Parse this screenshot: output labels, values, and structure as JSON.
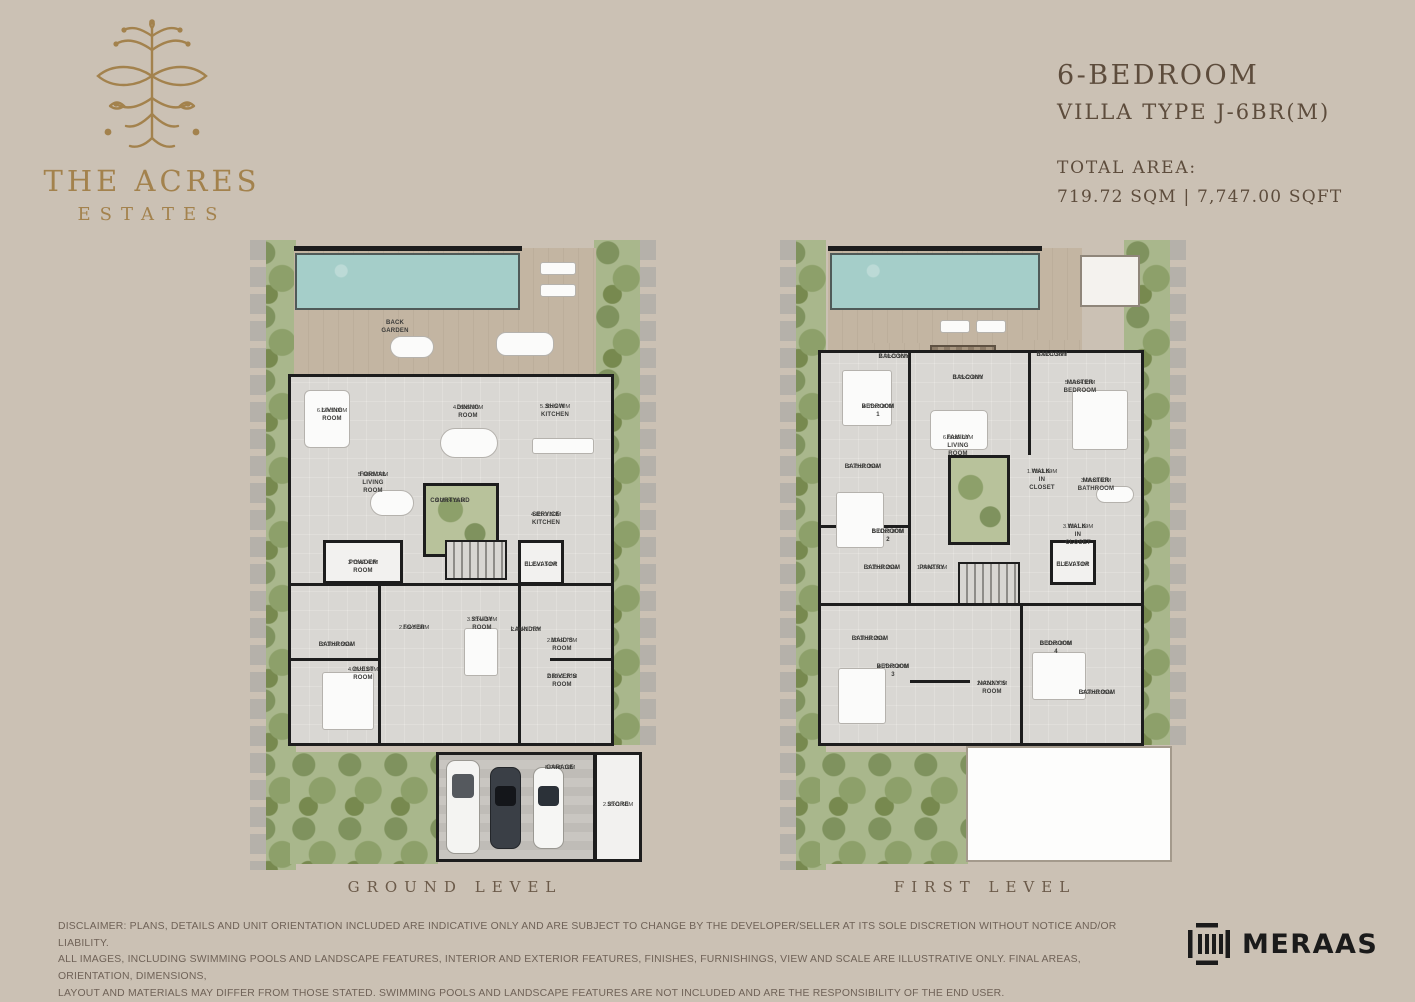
{
  "brand": {
    "name_line1": "THE ACRES",
    "name_line2": "ESTATES"
  },
  "header": {
    "title_line1": "6-BEDROOM",
    "title_line2": "VILLA TYPE J-6BR(M)",
    "total_area_label": "TOTAL AREA:",
    "total_area_value": "719.72 SQM | 7,747.00 SQFT"
  },
  "plans": {
    "ground": {
      "caption": "GROUND LEVEL",
      "outdoor_label": "BACK GARDEN",
      "rooms": [
        {
          "name": "LIVING ROOM",
          "dims": "6.60x5.00M"
        },
        {
          "name": "DINING ROOM",
          "dims": "4.35x5.00M"
        },
        {
          "name": "SHOW KITCHEN",
          "dims": "5.35x5.70M"
        },
        {
          "name": "FORMAL LIVING ROOM",
          "dims": "5.60x5.00M"
        },
        {
          "name": "COURTYARD",
          "dims": "3.95x4.05M"
        },
        {
          "name": "SERVICE KITCHEN",
          "dims": "4.85x3.50M"
        },
        {
          "name": "POWDER ROOM",
          "dims": "3.75x2.40M"
        },
        {
          "name": "ELEVATOR",
          "dims": "1.75x1.50M"
        },
        {
          "name": "FOYER",
          "dims": "2.55x3.50M"
        },
        {
          "name": "STUDY ROOM",
          "dims": "3.75x4.50M"
        },
        {
          "name": "LAUNDRY",
          "dims": "2.00x1.75M"
        },
        {
          "name": "MAID'S ROOM",
          "dims": "2.30x2.70M"
        },
        {
          "name": "BATHROOM",
          "dims": "3.10x2.55M"
        },
        {
          "name": "GUEST ROOM",
          "dims": "4.75x3.80M"
        },
        {
          "name": "DRIVER'S ROOM",
          "dims": "2.10x2.20M"
        },
        {
          "name": "GARAGE",
          "dims": "8.00x6.10M"
        },
        {
          "name": "STORE",
          "dims": "2.25x1.60M"
        }
      ]
    },
    "first": {
      "caption": "FIRST LEVEL",
      "rooms": [
        {
          "name": "BALCONY",
          "dims": "2.70x3.95M"
        },
        {
          "name": "BALCONY",
          "dims": "3.75x2.00M"
        },
        {
          "name": "BALCONY",
          "dims": "3.10x1.50M"
        },
        {
          "name": "BEDROOM 1",
          "dims": "4.75x3.80M"
        },
        {
          "name": "MASTER BEDROOM",
          "dims": "5.10x4.95M"
        },
        {
          "name": "FAMILY LIVING ROOM",
          "dims": "6.00x5.00M"
        },
        {
          "name": "BATHROOM",
          "dims": "2.75x2.05M"
        },
        {
          "name": "WALK-IN CLOSET",
          "dims": "1.70x3.80M"
        },
        {
          "name": "MASTER BATHROOM",
          "dims": "3.05x3.60M"
        },
        {
          "name": "BEDROOM 2",
          "dims": "5.00x3.80M"
        },
        {
          "name": "WALK-IN CLOSET",
          "dims": "3.10x1.80M"
        },
        {
          "name": "BATHROOM",
          "dims": "3.15x2.25M"
        },
        {
          "name": "PANTRY",
          "dims": "1.60x2.50M"
        },
        {
          "name": "ELEVATOR",
          "dims": "1.75x1.50M"
        },
        {
          "name": "BATHROOM",
          "dims": "3.10x2.25M"
        },
        {
          "name": "BEDROOM 3",
          "dims": "4.75x3.80M"
        },
        {
          "name": "NANNY'S ROOM",
          "dims": "2.60x2.30M"
        },
        {
          "name": "BEDROOM 4",
          "dims": "3.30x5.00M"
        },
        {
          "name": "BATHROOM",
          "dims": "2.20x3.65M"
        }
      ]
    }
  },
  "footer": {
    "disclaimer_line1": "DISCLAIMER: PLANS, DETAILS AND UNIT ORIENTATION INCLUDED ARE INDICATIVE ONLY AND ARE SUBJECT TO CHANGE BY THE DEVELOPER/SELLER AT ITS SOLE DISCRETION WITHOUT NOTICE AND/OR LIABILITY.",
    "disclaimer_line2": "ALL IMAGES, INCLUDING SWIMMING POOLS AND LANDSCAPE FEATURES, INTERIOR AND EXTERIOR FEATURES, FINISHES, FURNISHINGS, VIEW AND SCALE ARE ILLUSTRATIVE ONLY. FINAL AREAS, ORIENTATION, DIMENSIONS,",
    "disclaimer_line3": "LAYOUT AND MATERIALS MAY DIFFER FROM THOSE STATED. SWIMMING POOLS AND LANDSCAPE FEATURES ARE NOT INCLUDED AND ARE THE RESPONSIBILITY OF THE END USER.",
    "developer_logo_text": "MERAAS"
  },
  "colors": {
    "page_background": "#cbc1b4",
    "brand_gold": "#a3824d",
    "heading_brown": "#5d4c3c",
    "pool_teal": "#a5cec9",
    "deck_tan": "#c3b5a2",
    "landscape_green": "#a9b78c",
    "wall_black": "#1d1d1d",
    "floor_gray": "#e7e5e1",
    "logo_black": "#1b1b1b"
  }
}
